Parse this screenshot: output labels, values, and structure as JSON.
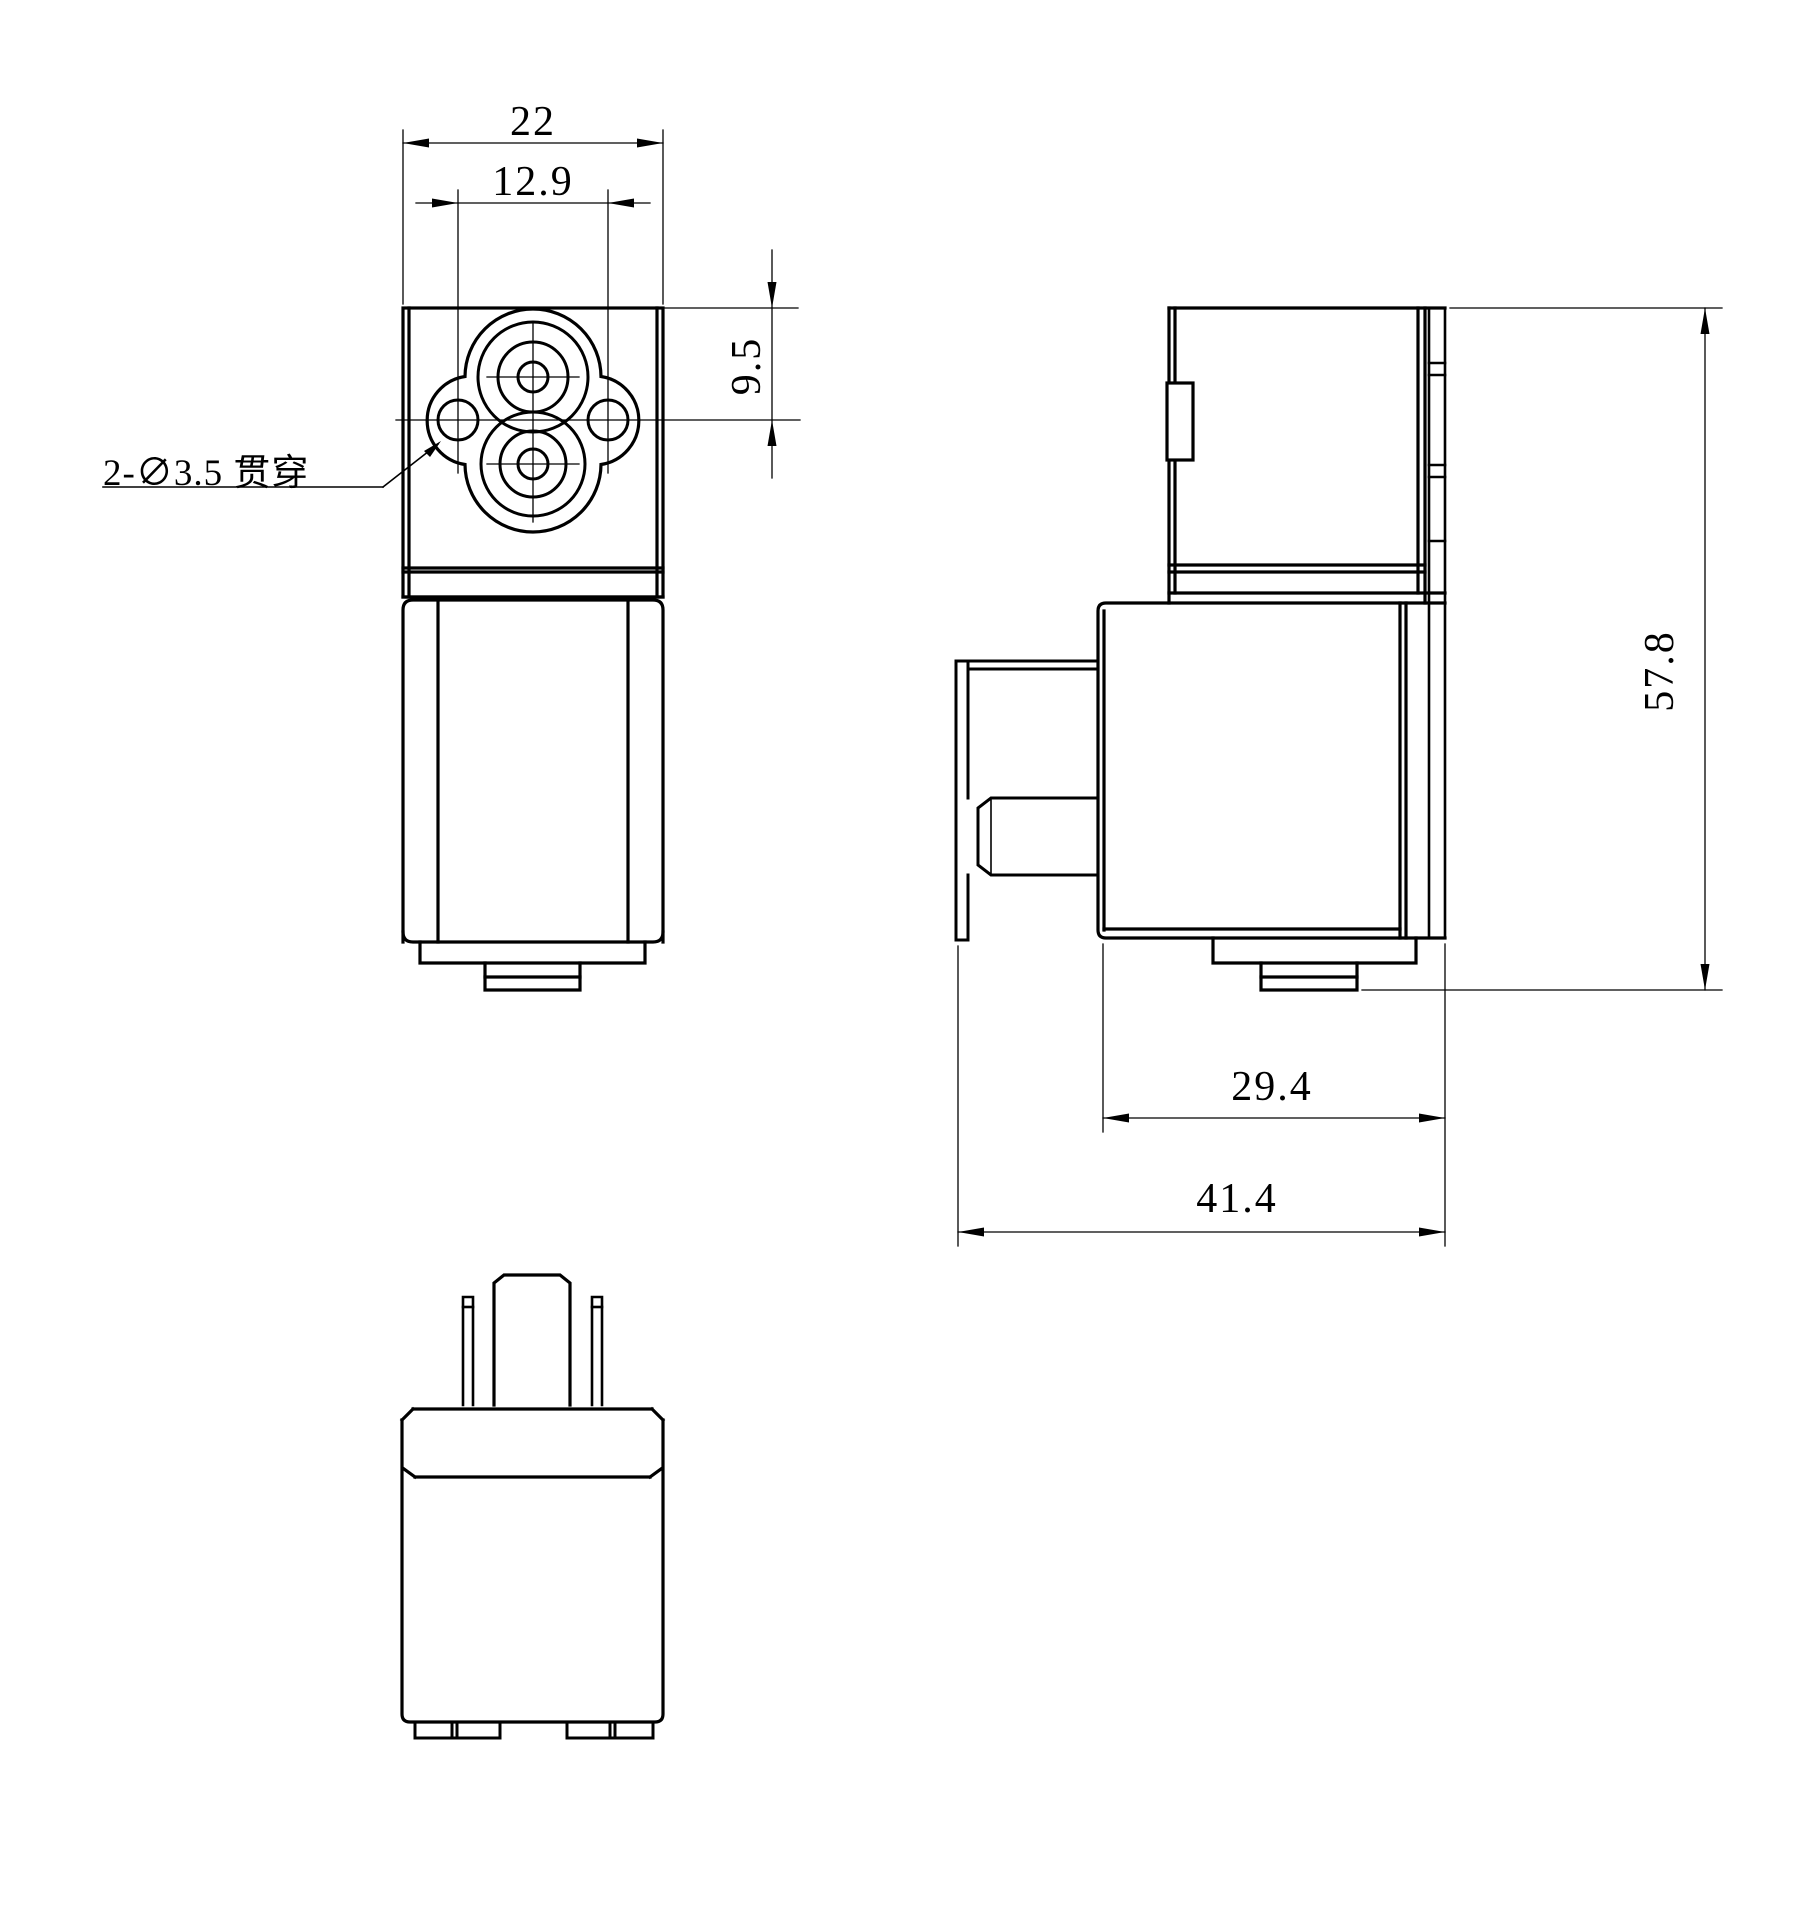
{
  "drawing": {
    "background": "#ffffff",
    "line_color": "#000000",
    "dimensions": {
      "width_overall": "22",
      "hole_spacing": "12.9",
      "top_to_hole_center": "9.5",
      "height_overall": "57.8",
      "housing_depth": "29.4",
      "depth_overall": "41.4"
    },
    "labels": {
      "through_holes": "2-∅3.5 贯穿"
    }
  }
}
